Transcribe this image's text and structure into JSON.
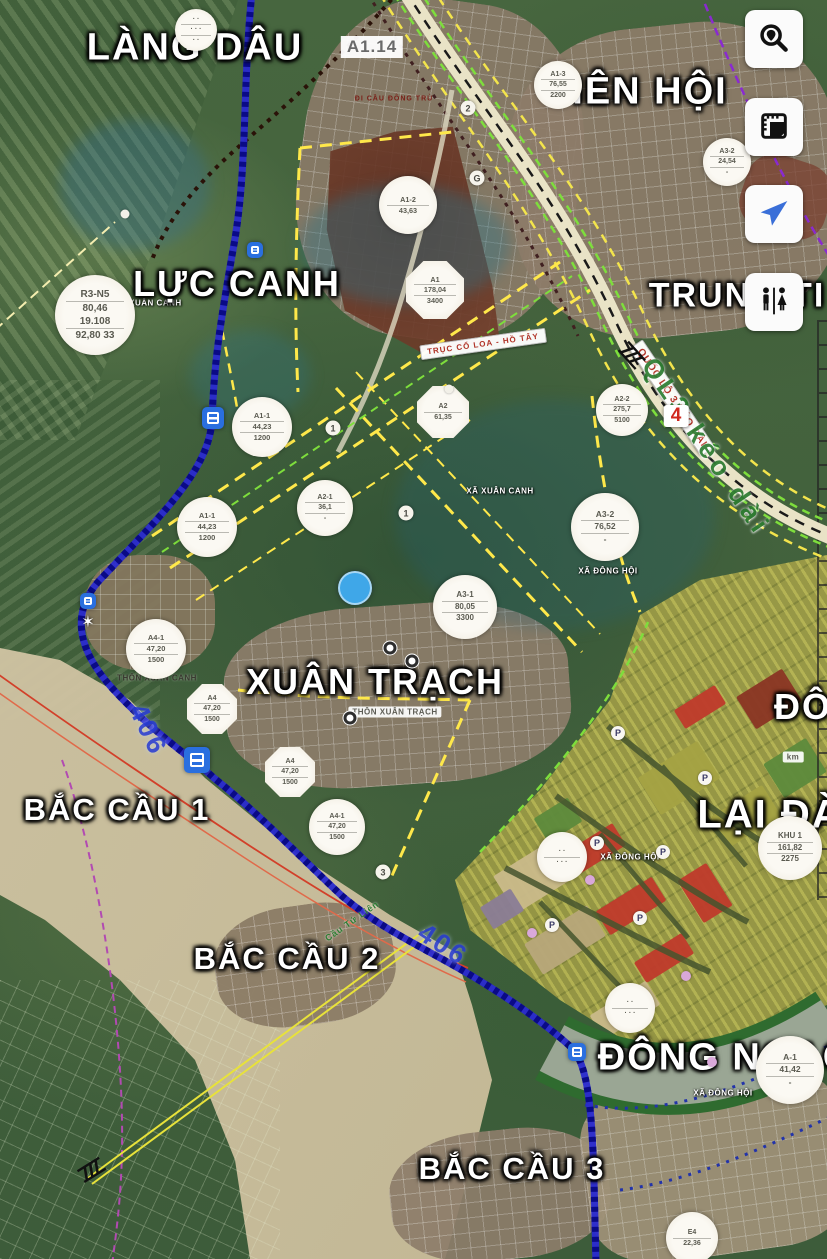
{
  "theme": {
    "button_bg": "#fbfbfb",
    "icon_color": "#111111",
    "locate_blue": "#3a6fd8",
    "river_blue": "#2323c8",
    "road_cream": "#e9e3c6",
    "dash_yellow": "#f3e44c",
    "dash_green": "#7ede3c",
    "dash_purple": "#9a3ad0",
    "label_white": "#ffffff",
    "road_label_red": "#b03226",
    "road_name_green": "#2e7d32",
    "road_406_blue": "#2b3fd4",
    "sand": "#cec2a2",
    "masterplan_red": "#bf3a2b"
  },
  "toolbar": {
    "buttons": [
      {
        "id": "search-place-button",
        "icon": "search-location-icon"
      },
      {
        "id": "planning-map-button",
        "icon": "ruler-document-icon"
      },
      {
        "id": "my-location-button",
        "icon": "navigation-arrow-icon"
      },
      {
        "id": "restroom-finder-button",
        "icon": "restroom-icon"
      }
    ]
  },
  "map": {
    "place_labels": [
      {
        "name": "label-lang-dau",
        "text": "LÀNG DÂU",
        "x": 195,
        "y": 48,
        "size": 38
      },
      {
        "name": "label-tien-hoi",
        "text": "IÊN HỘI",
        "x": 650,
        "y": 92,
        "size": 38
      },
      {
        "name": "label-trung-ti",
        "text": "TRUNG TI",
        "x": 737,
        "y": 296,
        "size": 34
      },
      {
        "name": "label-luc-canh",
        "text": "LỰC CANH",
        "x": 237,
        "y": 284,
        "size": 36
      },
      {
        "name": "label-xuan-trach",
        "text": "XUÂN TRẠCH",
        "x": 375,
        "y": 682,
        "size": 36
      },
      {
        "name": "label-bac-cau-1",
        "text": "BẮC CẦU 1",
        "x": 117,
        "y": 810,
        "size": 31
      },
      {
        "name": "label-bac-cau-2",
        "text": "BẮC CẦU 2",
        "x": 287,
        "y": 959,
        "size": 31
      },
      {
        "name": "label-bac-cau-3",
        "text": "BẮC CẦU 3",
        "x": 512,
        "y": 1169,
        "size": 31
      },
      {
        "name": "label-dong-ngac",
        "text": "ĐÔNG NGẠC",
        "x": 725,
        "y": 1058,
        "size": 38
      },
      {
        "name": "label-lai-da",
        "text": "LẠI ĐÀ",
        "x": 770,
        "y": 815,
        "size": 40
      },
      {
        "name": "label-dong",
        "text": "ĐÔNG",
        "x": 832,
        "y": 707,
        "size": 36
      }
    ],
    "area_labels": [
      {
        "text": "XÃ XUÂN CANH",
        "x": 148,
        "y": 303
      },
      {
        "text": "XÃ XUÂN CANH",
        "x": 500,
        "y": 491
      },
      {
        "text": "XÃ ĐÔNG HỘI",
        "x": 608,
        "y": 571
      },
      {
        "text": "XÃ ĐÔNG HỘI",
        "x": 630,
        "y": 857
      },
      {
        "text": "XÃ ĐÔNG HỘI",
        "x": 723,
        "y": 1093
      },
      {
        "text": "THÔN XUÂN TRẠCH",
        "x": 395,
        "y": 712,
        "variant": "boxed"
      },
      {
        "text": "THÔN XUÂN CANH",
        "x": 157,
        "y": 678,
        "variant": "dark"
      },
      {
        "text": "ĐI CẦU ĐÔNG TRÙ",
        "x": 394,
        "y": 99,
        "variant": "darkred"
      },
      {
        "text": "km",
        "x": 793,
        "y": 757,
        "variant": "boxed"
      },
      {
        "text": "A1.14",
        "x": 372,
        "y": 47,
        "variant": "big-box"
      }
    ],
    "road_labels": [
      {
        "name": "label-truc-co-loa-ho-tay",
        "text": "TRỤC CỔ LOA - HỒ TÂY",
        "x": 483,
        "y": 344,
        "rot": -8,
        "size": 8,
        "variant": "redbox"
      },
      {
        "name": "label-quoc-lo-3-keo-dai",
        "text": "QUỐC LỘ 3 KÉO DÀI",
        "x": 672,
        "y": 398,
        "rot": 56,
        "size": 10,
        "variant": "redbox"
      },
      {
        "name": "label-ql3-keo-dai",
        "text": "QL3 kéo dài",
        "x": 706,
        "y": 447,
        "rot": 56,
        "size": 27,
        "variant": "green-road"
      },
      {
        "name": "label-route-406-a",
        "text": "406",
        "x": 148,
        "y": 730,
        "rot": 64,
        "size": 27,
        "variant": "blue-road"
      },
      {
        "name": "label-route-406-b",
        "text": "406",
        "x": 443,
        "y": 945,
        "rot": 33,
        "size": 27,
        "variant": "blue-road"
      },
      {
        "name": "label-cau-tu-lien",
        "text": "Cầu Tứ Liên",
        "x": 352,
        "y": 921,
        "rot": -35,
        "size": 9,
        "variant": "green-road-small"
      },
      {
        "name": "route-4-badge",
        "text": "4",
        "x": 676,
        "y": 416,
        "rot": 0,
        "size": 19,
        "variant": "white-box-red"
      }
    ],
    "plot_circles": [
      {
        "x": 95,
        "y": 315,
        "r": 40,
        "lines": [
          "R3-N5",
          "80,46  19.108",
          "92,80  33"
        ]
      },
      {
        "x": 196,
        "y": 30,
        "r": 21,
        "lines": [
          "· ·",
          "· · ·",
          "· ·"
        ]
      },
      {
        "x": 558,
        "y": 85,
        "r": 24,
        "lines": [
          "A1-3",
          "76,55",
          "2200"
        ]
      },
      {
        "x": 727,
        "y": 162,
        "r": 24,
        "lines": [
          "A3-2",
          "24,54",
          "-"
        ]
      },
      {
        "x": 408,
        "y": 205,
        "r": 29,
        "lines": [
          "A1-2",
          "43,63",
          ""
        ]
      },
      {
        "x": 435,
        "y": 290,
        "r": 29,
        "lines": [
          "A1",
          "178,04",
          "3400"
        ],
        "shape": "octagon"
      },
      {
        "x": 262,
        "y": 427,
        "r": 30,
        "lines": [
          "A1-1",
          "44,23",
          "1200"
        ]
      },
      {
        "x": 207,
        "y": 527,
        "r": 30,
        "lines": [
          "A1-1",
          "44,23",
          "1200"
        ]
      },
      {
        "x": 325,
        "y": 508,
        "r": 28,
        "lines": [
          "A2-1",
          "36,1",
          "-"
        ]
      },
      {
        "x": 443,
        "y": 412,
        "r": 26,
        "lines": [
          "A2",
          "61,35",
          ""
        ],
        "shape": "octagon"
      },
      {
        "x": 622,
        "y": 410,
        "r": 26,
        "lines": [
          "A2-2",
          "275,7",
          "5100"
        ]
      },
      {
        "x": 605,
        "y": 527,
        "r": 34,
        "lines": [
          "A3-2",
          "76,52",
          "-"
        ]
      },
      {
        "x": 465,
        "y": 607,
        "r": 32,
        "lines": [
          "A3-1",
          "80,05",
          "3300"
        ]
      },
      {
        "x": 156,
        "y": 649,
        "r": 30,
        "lines": [
          "A4-1",
          "47,20",
          "1500"
        ]
      },
      {
        "x": 212,
        "y": 709,
        "r": 25,
        "lines": [
          "A4",
          "47,20",
          "1500"
        ],
        "shape": "octagon"
      },
      {
        "x": 290,
        "y": 772,
        "r": 25,
        "lines": [
          "A4",
          "47,20",
          "1500"
        ],
        "shape": "octagon"
      },
      {
        "x": 337,
        "y": 827,
        "r": 28,
        "lines": [
          "A4-1",
          "47,20",
          "1500"
        ]
      },
      {
        "x": 790,
        "y": 848,
        "r": 32,
        "lines": [
          "KHU 1",
          "161,82",
          "2275"
        ]
      },
      {
        "x": 562,
        "y": 857,
        "r": 25,
        "lines": [
          "· ·",
          "· · ·",
          ""
        ]
      },
      {
        "x": 630,
        "y": 1008,
        "r": 25,
        "lines": [
          "· ·",
          "· · ·",
          ""
        ]
      },
      {
        "x": 790,
        "y": 1070,
        "r": 34,
        "lines": [
          "A-1",
          "41,42",
          "-"
        ]
      },
      {
        "x": 692,
        "y": 1238,
        "r": 26,
        "lines": [
          "E4",
          "22,36",
          ""
        ]
      }
    ],
    "badges": [
      {
        "text": "2",
        "x": 468,
        "y": 108
      },
      {
        "text": "G",
        "x": 477,
        "y": 178
      },
      {
        "text": "1",
        "x": 333,
        "y": 428
      },
      {
        "text": "1",
        "x": 406,
        "y": 513
      },
      {
        "text": "3",
        "x": 383,
        "y": 872
      }
    ],
    "icons": [
      {
        "type": "transit",
        "x": 255,
        "y": 250,
        "s": 16
      },
      {
        "type": "transit",
        "x": 213,
        "y": 418,
        "s": 22
      },
      {
        "type": "transit",
        "x": 88,
        "y": 601,
        "s": 16
      },
      {
        "type": "transit",
        "x": 197,
        "y": 760,
        "s": 26
      },
      {
        "type": "transit",
        "x": 577,
        "y": 1052,
        "s": 18
      },
      {
        "type": "parking",
        "x": 618,
        "y": 733
      },
      {
        "type": "parking",
        "x": 705,
        "y": 778
      },
      {
        "type": "parking",
        "x": 597,
        "y": 843
      },
      {
        "type": "parking",
        "x": 663,
        "y": 852
      },
      {
        "type": "parking",
        "x": 552,
        "y": 925
      },
      {
        "type": "parking",
        "x": 640,
        "y": 918
      },
      {
        "type": "poi",
        "x": 390,
        "y": 648
      },
      {
        "type": "poi",
        "x": 412,
        "y": 661
      },
      {
        "type": "poi",
        "x": 350,
        "y": 718
      },
      {
        "type": "dot",
        "c": "#d9a8d9",
        "s": 10,
        "x": 590,
        "y": 880
      },
      {
        "type": "dot",
        "c": "#d9a8d9",
        "s": 10,
        "x": 532,
        "y": 933
      },
      {
        "type": "dot",
        "c": "#d9a8d9",
        "s": 10,
        "x": 686,
        "y": 976
      },
      {
        "type": "dot",
        "c": "#d9a8d9",
        "s": 10,
        "x": 712,
        "y": 1062
      },
      {
        "type": "dot",
        "c": "#f2f0e8",
        "s": 9,
        "x": 125,
        "y": 214
      },
      {
        "type": "dot",
        "c": "#f2f0e8",
        "s": 9,
        "x": 449,
        "y": 389
      },
      {
        "type": "star",
        "x": 88,
        "y": 622
      },
      {
        "type": "bridge",
        "x": 630,
        "y": 357,
        "rot": 48
      },
      {
        "type": "bridge",
        "x": 93,
        "y": 1172,
        "rot": -32
      }
    ],
    "masterplan": {
      "palette": {
        "red": "#bf3a2b",
        "darkred": "#8a3524",
        "khaki": "#c9b98a",
        "tan": "#b7a77a",
        "olive": "#a4a243",
        "green": "#5d8a3c",
        "purple": "#8a7c96"
      },
      "blocks": [
        {
          "x": 560,
          "y": 838,
          "w": 64,
          "h": 26,
          "c": "red"
        },
        {
          "x": 598,
          "y": 892,
          "w": 66,
          "h": 28,
          "c": "red"
        },
        {
          "x": 636,
          "y": 946,
          "w": 56,
          "h": 24,
          "c": "red"
        },
        {
          "x": 688,
          "y": 868,
          "w": 34,
          "h": 50,
          "c": "red"
        },
        {
          "x": 676,
          "y": 696,
          "w": 48,
          "h": 22,
          "c": "red"
        },
        {
          "x": 742,
          "y": 680,
          "w": 54,
          "h": 38,
          "c": "darkred"
        },
        {
          "x": 500,
          "y": 856,
          "w": 64,
          "h": 44,
          "c": "khaki"
        },
        {
          "x": 528,
          "y": 922,
          "w": 74,
          "h": 36,
          "c": "tan"
        },
        {
          "x": 592,
          "y": 996,
          "w": 66,
          "h": 28,
          "c": "khaki"
        },
        {
          "x": 484,
          "y": 896,
          "w": 36,
          "h": 26,
          "c": "purple"
        },
        {
          "x": 644,
          "y": 756,
          "w": 70,
          "h": 44,
          "c": "olive"
        },
        {
          "x": 716,
          "y": 798,
          "w": 60,
          "h": 36,
          "c": "olive"
        },
        {
          "x": 770,
          "y": 748,
          "w": 50,
          "h": 40,
          "c": "green"
        },
        {
          "x": 538,
          "y": 806,
          "w": 40,
          "h": 28,
          "c": "green"
        }
      ]
    }
  }
}
